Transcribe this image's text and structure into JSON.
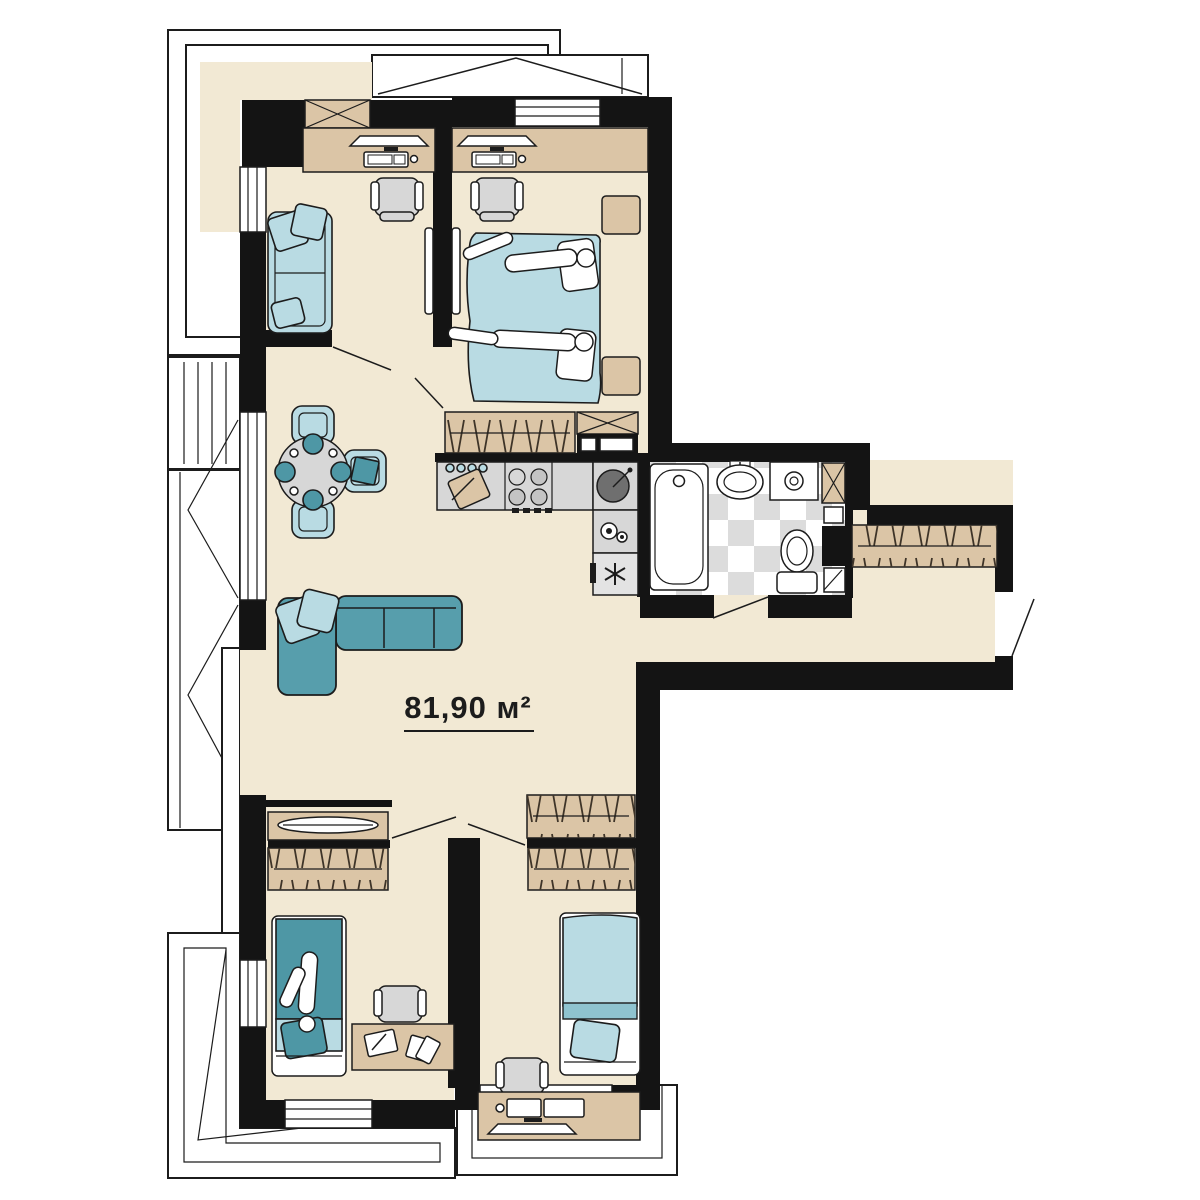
{
  "plan": {
    "area_label": "81,90 м²"
  },
  "colors": {
    "floor": "#F2E9D4",
    "wood": "#DBC5A6",
    "wall": "#141414",
    "teal": "#579EAC",
    "tealdark": "#4E97A5",
    "lightblue": "#B9DBE3",
    "gray": "#D7D7D7",
    "graydark": "#6F6F6F",
    "tile": "#DCDCDC",
    "line": "#1C1C1C"
  },
  "elements": {
    "rooms": [
      "study",
      "master-bedroom",
      "living-dining",
      "kitchen",
      "bathroom",
      "hallway",
      "bedroom-left",
      "bedroom-middle"
    ],
    "furniture_icons": [
      "desk-icon",
      "monitor-icon",
      "keyboard-icon",
      "chair-icon",
      "sofa-icon",
      "double-bed-icon",
      "single-bed-icon",
      "dining-table-icon",
      "wardrobe-icon",
      "stove-icon",
      "kitchen-sink-icon",
      "fridge-icon",
      "bathtub-icon",
      "washbasin-icon",
      "washing-machine-icon",
      "toilet-icon",
      "shelf-icon",
      "balcony-icon",
      "window-icon",
      "door-swing-icon",
      "vent-shaft-icon"
    ]
  }
}
